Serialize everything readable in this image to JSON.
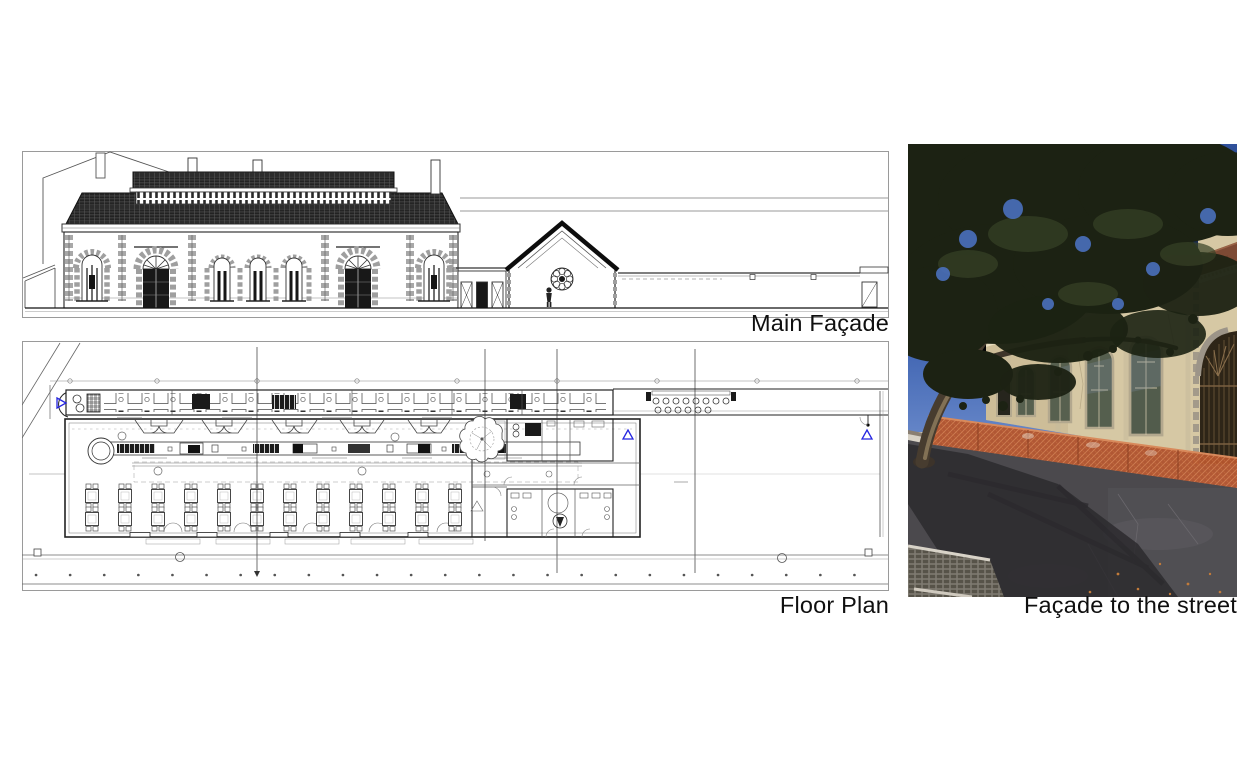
{
  "page": {
    "background_color": "#ffffff"
  },
  "panels": {
    "main_facade": {
      "caption": "Main Façade"
    },
    "floor_plan": {
      "caption": "Floor Plan"
    },
    "street_photo": {
      "caption": "Façade to the street"
    }
  },
  "colors": {
    "drawing_line": "#222222",
    "frame_border": "#9a9a9a",
    "section_marker_blue": "#2525e0",
    "caption_text": "#0f0f0f",
    "photo_sky": "#3c60ac",
    "photo_foliage": "#1c2213",
    "photo_wall": "#d6c8a4",
    "photo_roof": "#7d4a34",
    "photo_fence": "#b4552e",
    "photo_asphalt": "#4b494d"
  }
}
